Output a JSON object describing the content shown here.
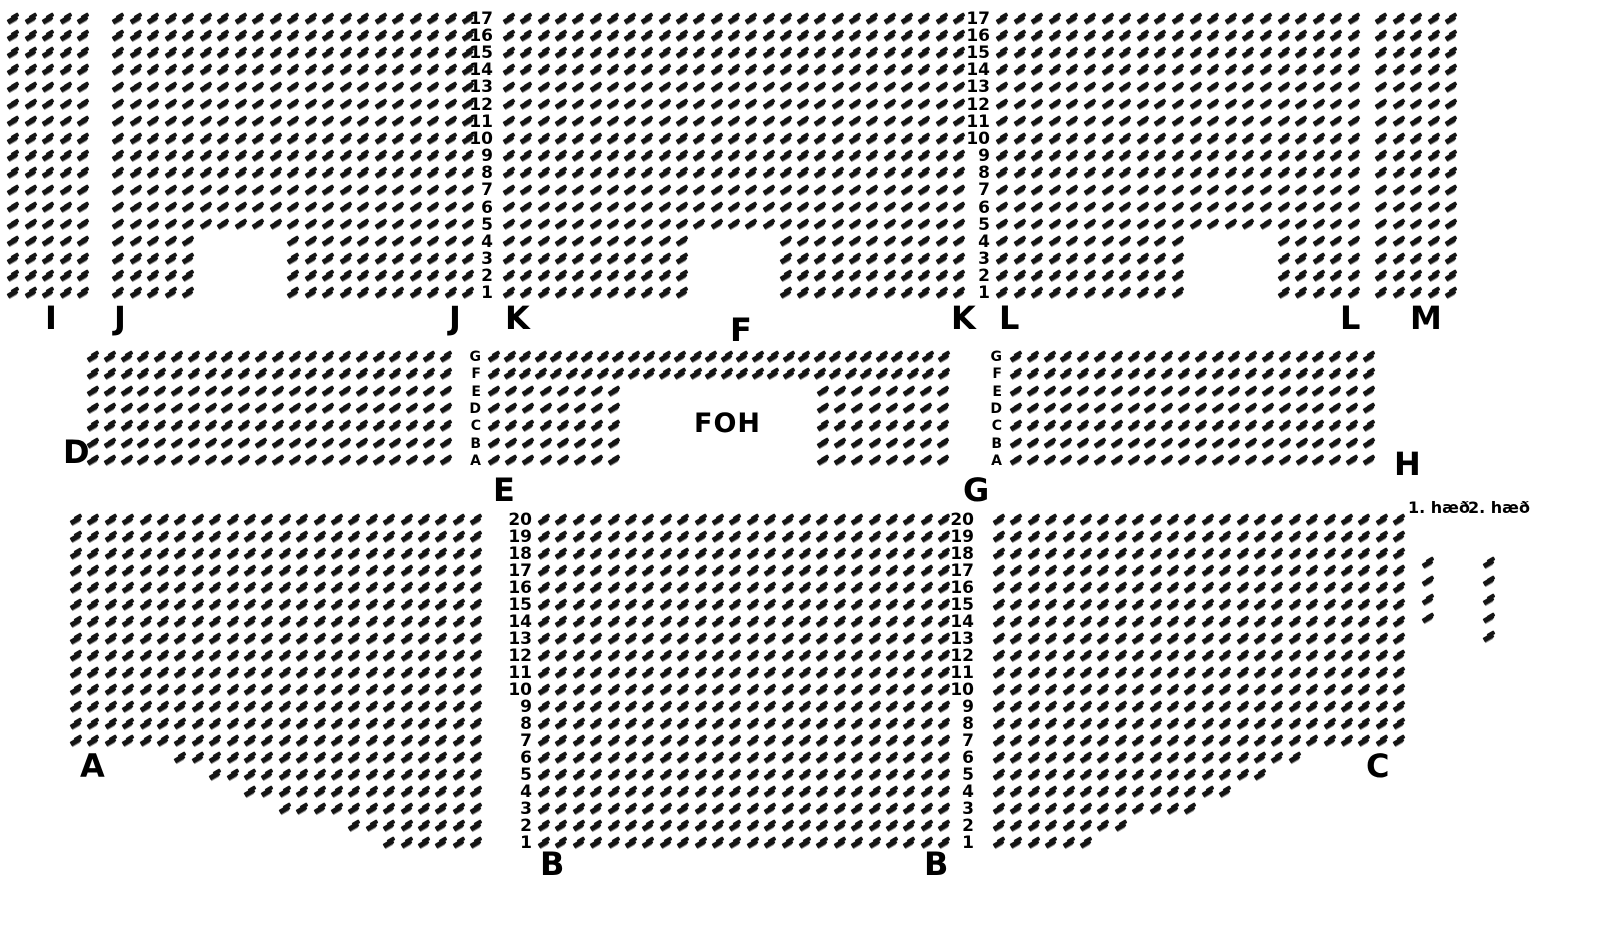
{
  "colors": {
    "seat": "#151515",
    "seat_shadow": "#8f8f8f",
    "text": "#000000",
    "background": "#ffffff"
  },
  "foh": {
    "label": "FOH"
  },
  "legend": {
    "items": [
      {
        "label": "1. hæð",
        "x": 1408,
        "y": 500,
        "seats_x": 1422,
        "seat_count": 4
      },
      {
        "label": "2. hæð",
        "x": 1468,
        "y": 500,
        "seats_x": 1483,
        "seat_count": 5
      }
    ],
    "seats_y0": 558,
    "seats_dy": 18.5
  },
  "section_labels": [
    {
      "text": "I",
      "x": 45,
      "y": 302
    },
    {
      "text": "J",
      "x": 114,
      "y": 302
    },
    {
      "text": "J",
      "x": 449,
      "y": 302
    },
    {
      "text": "K",
      "x": 505,
      "y": 302
    },
    {
      "text": "F",
      "x": 730,
      "y": 314
    },
    {
      "text": "K",
      "x": 951,
      "y": 302
    },
    {
      "text": "L",
      "x": 999,
      "y": 302
    },
    {
      "text": "L",
      "x": 1340,
      "y": 302
    },
    {
      "text": "M",
      "x": 1410,
      "y": 302
    },
    {
      "text": "D",
      "x": 63,
      "y": 436
    },
    {
      "text": "E",
      "x": 493,
      "y": 474
    },
    {
      "text": "G",
      "x": 963,
      "y": 474
    },
    {
      "text": "H",
      "x": 1394,
      "y": 448
    },
    {
      "text": "A",
      "x": 80,
      "y": 750
    },
    {
      "text": "B",
      "x": 540,
      "y": 848
    },
    {
      "text": "B",
      "x": 924,
      "y": 848
    },
    {
      "text": "C",
      "x": 1366,
      "y": 750
    }
  ],
  "row_label_columns": [
    {
      "x_right": 493,
      "y0": 14,
      "dy": 17.15,
      "font_size": 17,
      "values": [
        "17",
        "16",
        "15",
        "14",
        "13",
        "12",
        "11",
        "10",
        "9",
        "8",
        "7",
        "6",
        "5",
        "4",
        "3",
        "2",
        "1"
      ]
    },
    {
      "x_right": 990,
      "y0": 14,
      "dy": 17.15,
      "font_size": 17,
      "values": [
        "17",
        "16",
        "15",
        "14",
        "13",
        "12",
        "11",
        "10",
        "9",
        "8",
        "7",
        "6",
        "5",
        "4",
        "3",
        "2",
        "1"
      ]
    },
    {
      "x_right": 481,
      "y0": 352,
      "dy": 17.3,
      "font_size": 14,
      "values": [
        "G",
        "F",
        "E",
        "D",
        "C",
        "B",
        "A"
      ]
    },
    {
      "x_right": 1002,
      "y0": 352,
      "dy": 17.3,
      "font_size": 14,
      "values": [
        "G",
        "F",
        "E",
        "D",
        "C",
        "B",
        "A"
      ]
    },
    {
      "x_right": 532,
      "y0": 515,
      "dy": 17.0,
      "font_size": 17,
      "values": [
        "20",
        "19",
        "18",
        "17",
        "16",
        "15",
        "14",
        "13",
        "12",
        "11",
        "10",
        "9",
        "8",
        "7",
        "6",
        "5",
        "4",
        "3",
        "2",
        "1"
      ]
    },
    {
      "x_right": 974,
      "y0": 515,
      "dy": 17.0,
      "font_size": 17,
      "values": [
        "20",
        "19",
        "18",
        "17",
        "16",
        "15",
        "14",
        "13",
        "12",
        "11",
        "10",
        "9",
        "8",
        "7",
        "6",
        "5",
        "4",
        "3",
        "2",
        "1"
      ]
    }
  ],
  "sections": [
    {
      "id": "I",
      "x": 7,
      "y": 14,
      "dx": 17.5,
      "dy": 17.15,
      "rows": 17,
      "cols": 5
    },
    {
      "id": "J",
      "x": 112,
      "y": 14,
      "dx": 17.5,
      "dy": 17.15,
      "rows": 17,
      "cols": 21,
      "row_ranges": {
        "1": [
          [
            1,
            5
          ],
          [
            11,
            21
          ]
        ],
        "2": [
          [
            1,
            5
          ],
          [
            11,
            21
          ]
        ],
        "3": [
          [
            1,
            5
          ],
          [
            11,
            21
          ]
        ],
        "4": [
          [
            1,
            5
          ],
          [
            11,
            21
          ]
        ]
      }
    },
    {
      "id": "F-upper",
      "x": 503,
      "y": 14,
      "dx": 17.3,
      "dy": 17.15,
      "rows": 17,
      "cols": 27,
      "row_ranges": {
        "1": [
          [
            1,
            11
          ],
          [
            17,
            27
          ]
        ],
        "2": [
          [
            1,
            11
          ],
          [
            17,
            27
          ]
        ],
        "3": [
          [
            1,
            11
          ],
          [
            17,
            27
          ]
        ],
        "4": [
          [
            1,
            11
          ],
          [
            17,
            27
          ]
        ]
      }
    },
    {
      "id": "L",
      "x": 996,
      "y": 14,
      "dx": 17.6,
      "dy": 17.15,
      "rows": 17,
      "cols": 21,
      "row_ranges": {
        "1": [
          [
            1,
            11
          ],
          [
            17,
            21
          ]
        ],
        "2": [
          [
            1,
            11
          ],
          [
            17,
            21
          ]
        ],
        "3": [
          [
            1,
            11
          ],
          [
            17,
            21
          ]
        ],
        "4": [
          [
            1,
            11
          ],
          [
            17,
            21
          ]
        ]
      }
    },
    {
      "id": "M",
      "x": 1375,
      "y": 14,
      "dx": 17.5,
      "dy": 17.15,
      "rows": 17,
      "cols": 5
    },
    {
      "id": "D",
      "x": 87,
      "y": 352,
      "dx": 16.8,
      "dy": 17.3,
      "rows": 7,
      "cols": 22
    },
    {
      "id": "EG-wide",
      "x": 488,
      "y": 352,
      "dx": 15.5,
      "dy": 17.3,
      "rows": 2,
      "cols": 30
    },
    {
      "id": "E-block",
      "x": 488,
      "y": 386.6,
      "dx": 17.2,
      "dy": 17.3,
      "rows": 5,
      "cols": 8
    },
    {
      "id": "G-block",
      "x": 817,
      "y": 386.6,
      "dx": 17.2,
      "dy": 17.3,
      "rows": 5,
      "cols": 8
    },
    {
      "id": "H",
      "x": 1010,
      "y": 352,
      "dx": 16.8,
      "dy": 17.3,
      "rows": 7,
      "cols": 22
    },
    {
      "id": "A",
      "x": 70,
      "y": 515,
      "dx": 17.4,
      "dy": 17.0,
      "rows": 20,
      "cols": 24,
      "row_ranges": {
        "6": [
          [
            7,
            24
          ]
        ],
        "5": [
          [
            9,
            24
          ]
        ],
        "4": [
          [
            11,
            24
          ]
        ],
        "3": [
          [
            13,
            24
          ]
        ],
        "2": [
          [
            17,
            24
          ]
        ],
        "1": [
          [
            19,
            24
          ]
        ]
      }
    },
    {
      "id": "B",
      "x": 538,
      "y": 515,
      "dx": 17.4,
      "dy": 17.0,
      "rows": 20,
      "cols": 24
    },
    {
      "id": "C",
      "x": 993,
      "y": 515,
      "dx": 17.4,
      "dy": 17.0,
      "rows": 20,
      "cols": 24,
      "row_ranges": {
        "6": [
          [
            1,
            18
          ]
        ],
        "5": [
          [
            1,
            16
          ]
        ],
        "4": [
          [
            1,
            14
          ]
        ],
        "3": [
          [
            1,
            12
          ]
        ],
        "2": [
          [
            1,
            8
          ]
        ],
        "1": [
          [
            1,
            6
          ]
        ]
      }
    }
  ]
}
